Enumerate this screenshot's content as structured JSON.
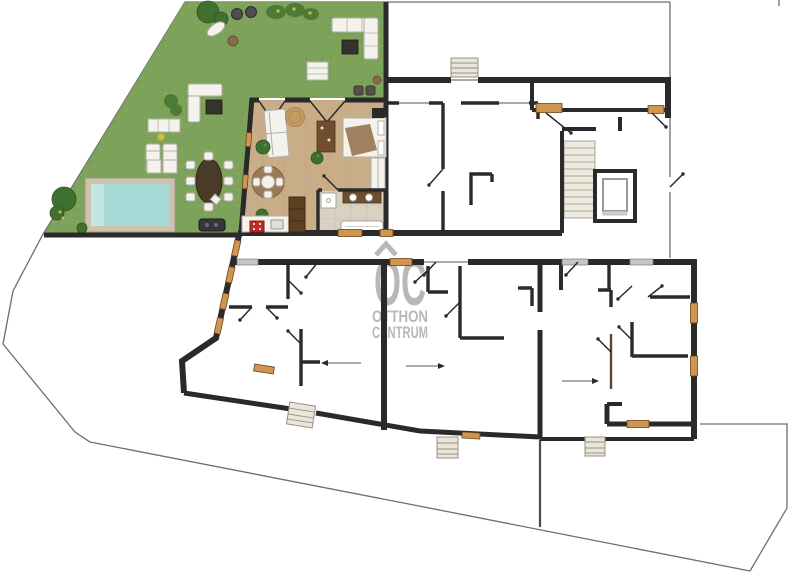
{
  "watermark": {
    "logo": "OC",
    "tagline_line1": "OTTHON",
    "tagline_line2": "CENTRUM"
  },
  "colors": {
    "wall": "#2a2a2a",
    "boundary": "#6e6e6e",
    "lawn": "#7da35b",
    "lawn_shade": "#719650",
    "lawn_light": "#8db368",
    "bush": "#4e7a38",
    "tree": "#3f6d33",
    "pool_water": "#a6d8d5",
    "pool_step": "#c2e6e3",
    "pool_deck": "#cbc3aa",
    "wood_floor": "#c9ad89",
    "tile": "#d9d2c2",
    "window_wood": "#cf9650",
    "window_sill": "#c6c6c6",
    "watermark": "#b3b3b3",
    "steps": "#eae6db",
    "white_furn": "#f4f2ec",
    "dark_furn": "#36322c",
    "brown_furn": "#6f4f30",
    "stove": "#c22b25",
    "plant": "#3f7030",
    "rug": "#c29a62",
    "bed_throw": "#9b7a57",
    "yellow_flower": "#d8b83a"
  },
  "elements": {
    "site": [
      "property-boundary",
      "garden",
      "swimming-pool",
      "entrance-steps"
    ],
    "building": [
      "furnished-apartment",
      "upper-apartment",
      "stairwell",
      "elevator",
      "lower-left-apartment",
      "lower-middle-apartment",
      "lower-right-apartment"
    ],
    "garden_furniture": [
      "garden-sofa",
      "sun-loungers",
      "outdoor-dining-table",
      "bbq-grill",
      "trees",
      "flower-beds"
    ],
    "apartment_furniture": [
      "sofa",
      "bed",
      "wardrobe",
      "dining-set",
      "kitchen-counter",
      "stove",
      "bathroom"
    ]
  }
}
